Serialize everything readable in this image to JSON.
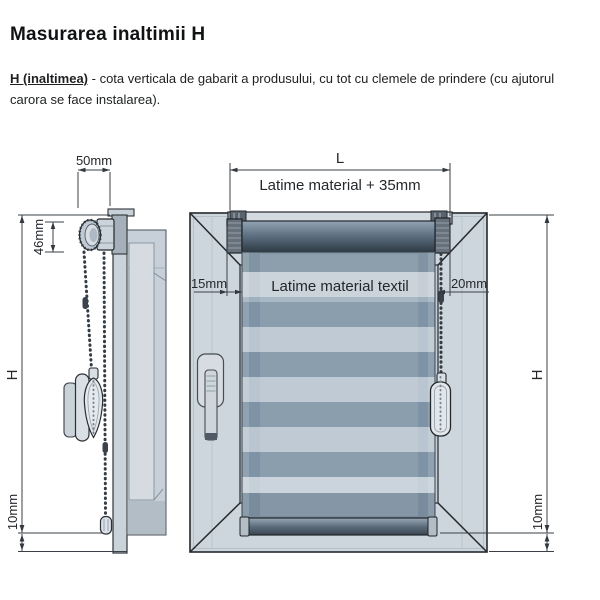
{
  "header": {
    "title": "Masurarea inaltimii H",
    "definition_term": "H (inaltimea)",
    "definition_text": " - cota verticala de gabarit a produsului, cu tot cu clemele de prindere (cu ajutorul carora se face instalarea)."
  },
  "side_view": {
    "bracket_depth": "50mm",
    "clutch_diameter": "46mm",
    "height": "H",
    "bottom_clearance": "10mm"
  },
  "front_view": {
    "total_width": "L",
    "total_width_note": "Latime material + 35mm",
    "left_offset": "15mm",
    "fabric_width_label": "Latime material textil",
    "right_offset": "20mm",
    "height": "H",
    "bottom_clearance": "10mm"
  },
  "palette": {
    "outline": "#24292e",
    "frame_fill": "#ced6dd",
    "stripe_dark": "#7e93a5",
    "stripe_light": "#b9c5d0",
    "roller_dark": "#2f3b46"
  }
}
